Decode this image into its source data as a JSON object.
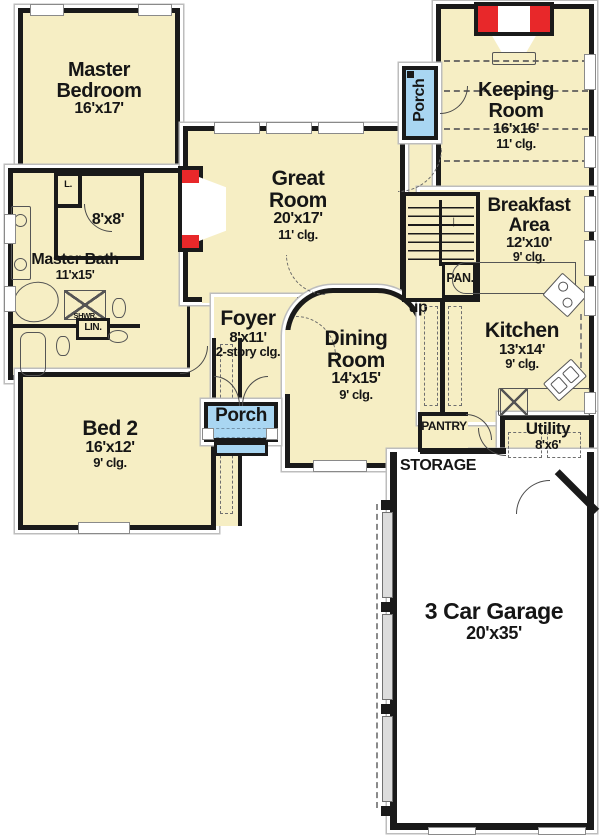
{
  "colors": {
    "room_fill": "#F6EEC4",
    "porch_fill": "#A9D6F2",
    "fireplace_red": "#E8282A",
    "wall": "#1A1A1A",
    "line": "#555555",
    "contour": "#BDBDBD"
  },
  "rooms": {
    "master_bedroom": {
      "title": "Master Bedroom",
      "dims": "16'x17'"
    },
    "closet": {
      "dims": "8'x8'"
    },
    "master_bath": {
      "title": "Master Bath",
      "dims": "11'x15'"
    },
    "bed2": {
      "title": "Bed 2",
      "dims": "16'x12'",
      "clg": "9' clg."
    },
    "foyer": {
      "title": "Foyer",
      "dims": "8'x11'",
      "clg": "2-story clg."
    },
    "great_room": {
      "title": "Great Room",
      "dims": "20'x17'",
      "clg": "11' clg."
    },
    "dining_room": {
      "title": "Dining Room",
      "dims": "14'x15'",
      "clg": "9' clg."
    },
    "keeping_room": {
      "title": "Keeping Room",
      "dims": "16'x16'",
      "clg": "11' clg."
    },
    "breakfast_area": {
      "title": "Breakfast Area",
      "dims": "12'x10'",
      "clg": "9' clg."
    },
    "kitchen": {
      "title": "Kitchen",
      "dims": "13'x14'",
      "clg": "9' clg."
    },
    "utility": {
      "title": "Utility",
      "dims": "8'x6'"
    },
    "garage": {
      "title": "3 Car Garage",
      "dims": "20'x35'"
    },
    "porch_front": {
      "title": "Porch"
    },
    "porch_side": {
      "title": "Porch"
    }
  },
  "labels": {
    "pantry": "PANTRY",
    "storage": "STORAGE",
    "pan": "PAN.",
    "up": "up",
    "lin": "LIN.",
    "l": "L.",
    "shwr": "SHWR.",
    "down_arrow": "↓"
  }
}
